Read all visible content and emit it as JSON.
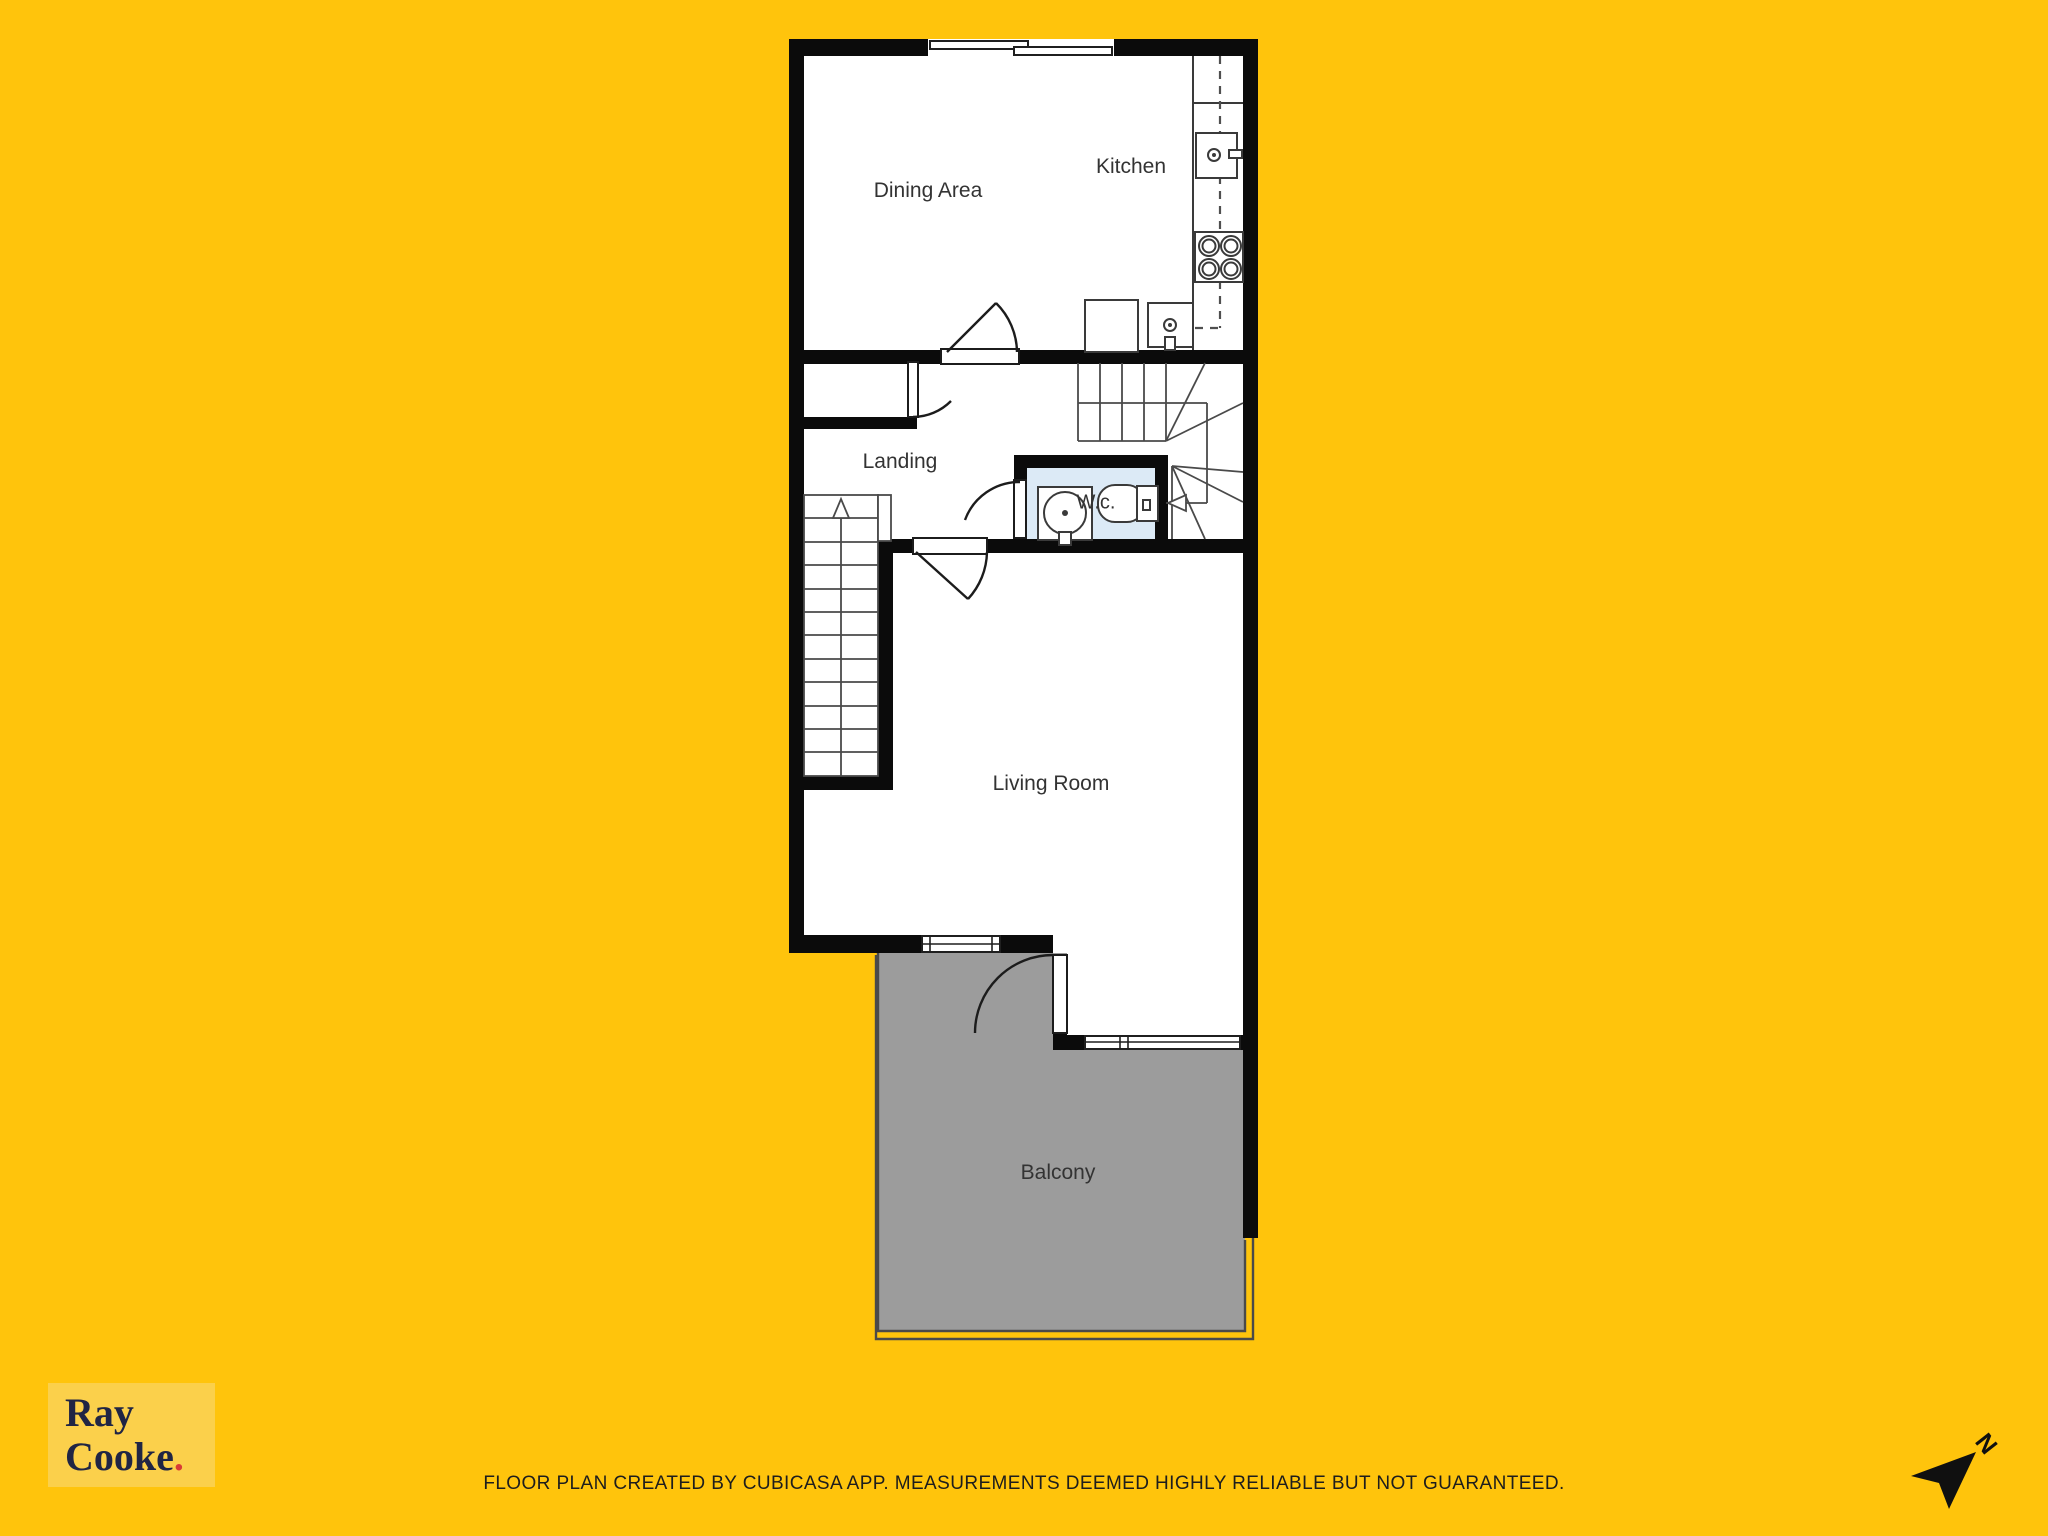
{
  "colors": {
    "background": "#FFC40C",
    "wall": "#0B0B0B",
    "room_fill": "#FFFFFF",
    "balcony_fill": "#9C9C9C",
    "wc_fill": "#DCEAF6",
    "fixture_stroke": "#3A3A3A",
    "label_text": "#333333",
    "logo_bg": "#FBD04B",
    "logo_text": "#202544",
    "logo_dot": "#D93B36",
    "footer_text": "#1D1D1D"
  },
  "floor_plan": {
    "rooms": [
      {
        "name": "Dining Area"
      },
      {
        "name": "Kitchen"
      },
      {
        "name": "Landing"
      },
      {
        "name": "W.c."
      },
      {
        "name": "Living Room"
      },
      {
        "name": "Balcony"
      }
    ]
  },
  "branding": {
    "name_line1": "Ray",
    "name_line2": "Cooke",
    "dot": "."
  },
  "footer": {
    "disclaimer": "FLOOR PLAN CREATED BY CUBICASA APP. MEASUREMENTS DEEMED HIGHLY RELIABLE BUT NOT GUARANTEED."
  },
  "compass": {
    "north_label": "N"
  }
}
